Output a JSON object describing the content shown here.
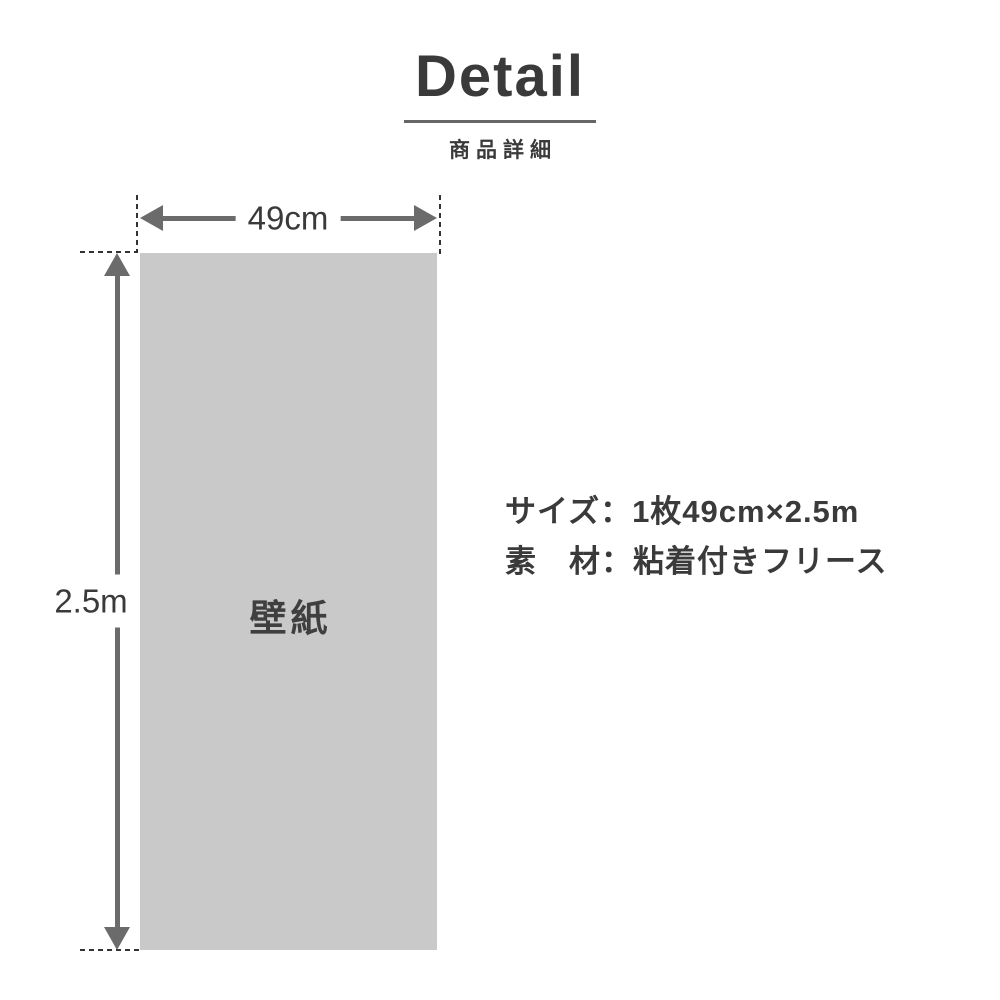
{
  "header": {
    "title": "Detail",
    "subtitle": "商品詳細"
  },
  "diagram": {
    "item_label": "壁紙",
    "width_label": "49cm",
    "height_label": "2.5m"
  },
  "specs": {
    "size_line": "サイズ：1枚49cm×2.5m",
    "material_line": "素　材：粘着付きフリース"
  },
  "colors": {
    "ink": "#3a3a3a",
    "arrow": "#6b6b6b",
    "dash": "#333333",
    "rect": "#c9c9c9",
    "divider": "#666666"
  }
}
